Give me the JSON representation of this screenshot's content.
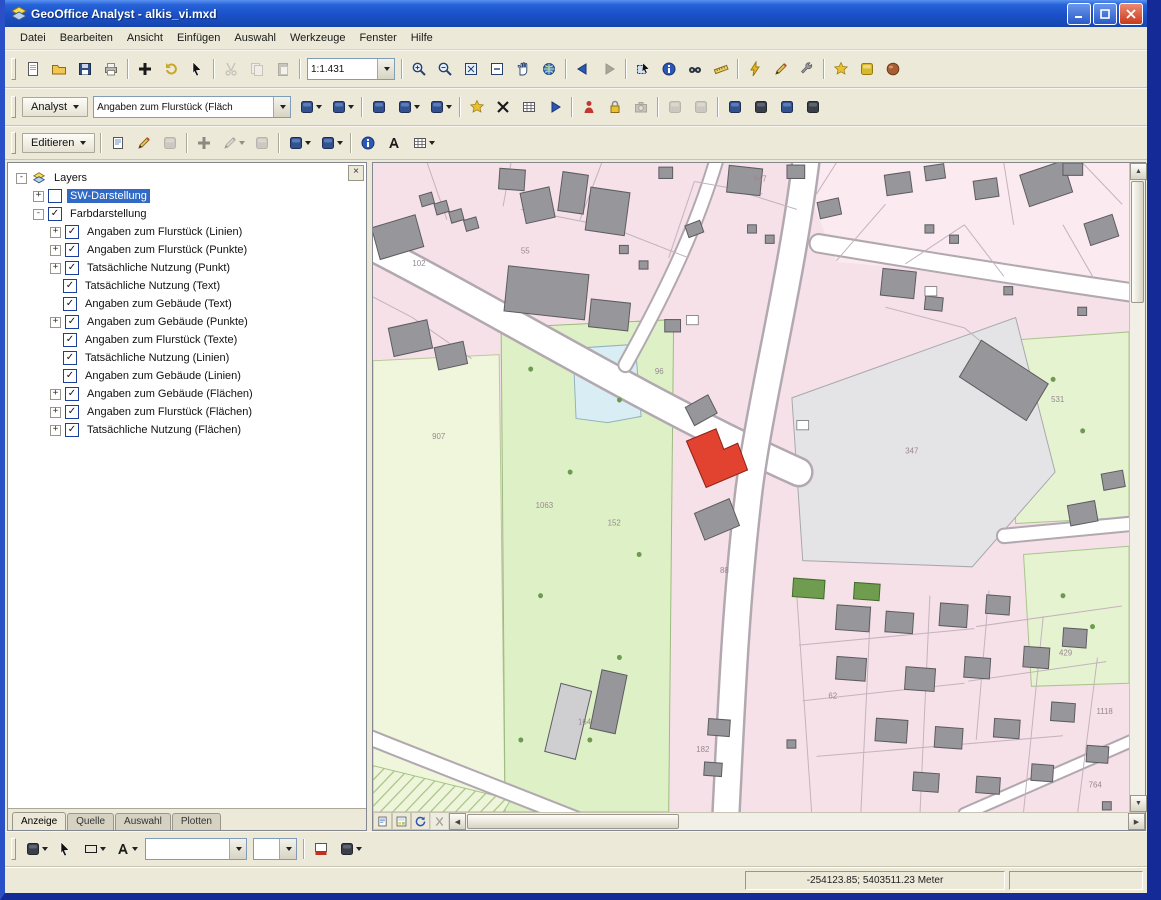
{
  "window": {
    "title": "GeoOffice Analyst - alkis_vi.mxd"
  },
  "menu": {
    "items": [
      "Datei",
      "Bearbeiten",
      "Ansicht",
      "Einfügen",
      "Auswahl",
      "Werkzeuge",
      "Fenster",
      "Hilfe"
    ]
  },
  "toolbar1": {
    "scale_value": "1:1.431"
  },
  "toolbar2": {
    "label": "Analyst",
    "combo_value": "Angaben zum Flurstück (Fläch"
  },
  "toolbar3": {
    "label": "Editieren"
  },
  "toolbar4": {
    "font_value": "",
    "size_value": ""
  },
  "toc": {
    "tabs": [
      "Anzeige",
      "Quelle",
      "Auswahl",
      "Plotten"
    ],
    "active_tab": "Anzeige",
    "layers": [
      {
        "label": "Layers",
        "level": 0,
        "expander": "-",
        "icon": "layers"
      },
      {
        "label": "SW-Darstellung",
        "level": 1,
        "expander": "+",
        "checked": false,
        "selected": true
      },
      {
        "label": "Farbdarstellung",
        "level": 1,
        "expander": "-",
        "checked": true
      },
      {
        "label": "Angaben zum Flurstück (Linien)",
        "level": 2,
        "expander": "+",
        "checked": true
      },
      {
        "label": "Angaben zum Flurstück (Punkte)",
        "level": 2,
        "expander": "+",
        "checked": true
      },
      {
        "label": "Tatsächliche Nutzung (Punkt)",
        "level": 2,
        "expander": "+",
        "checked": true
      },
      {
        "label": "Tatsächliche Nutzung (Text)",
        "level": 2,
        "checked": true
      },
      {
        "label": "Angaben zum Gebäude (Text)",
        "level": 2,
        "checked": true
      },
      {
        "label": "Angaben zum Gebäude (Punkte)",
        "level": 2,
        "expander": "+",
        "checked": true
      },
      {
        "label": "Angaben zum Flurstück (Texte)",
        "level": 2,
        "checked": true
      },
      {
        "label": "Tatsächliche Nutzung (Linien)",
        "level": 2,
        "checked": true
      },
      {
        "label": "Angaben zum Gebäude (Linien)",
        "level": 2,
        "checked": true
      },
      {
        "label": "Angaben zum Gebäude (Flächen)",
        "level": 2,
        "expander": "+",
        "checked": true
      },
      {
        "label": "Angaben zum Flurstück (Flächen)",
        "level": 2,
        "expander": "+",
        "checked": true
      },
      {
        "label": "Tatsächliche Nutzung (Flächen)",
        "level": 2,
        "expander": "+",
        "checked": true
      }
    ]
  },
  "map": {
    "selected_building_color": "#e24330",
    "labels": [
      {
        "text": "847",
        "x": 386,
        "y": 18
      },
      {
        "text": "102",
        "x": 40,
        "y": 100
      },
      {
        "text": "55",
        "x": 150,
        "y": 88
      },
      {
        "text": "907",
        "x": 60,
        "y": 268
      },
      {
        "text": "1063",
        "x": 165,
        "y": 335
      },
      {
        "text": "152",
        "x": 238,
        "y": 352
      },
      {
        "text": "96",
        "x": 286,
        "y": 205
      },
      {
        "text": "347",
        "x": 540,
        "y": 282
      },
      {
        "text": "531",
        "x": 688,
        "y": 232
      },
      {
        "text": "164",
        "x": 208,
        "y": 545
      },
      {
        "text": "88",
        "x": 352,
        "y": 398
      },
      {
        "text": "429",
        "x": 696,
        "y": 478
      },
      {
        "text": "1118",
        "x": 734,
        "y": 535
      },
      {
        "text": "764",
        "x": 726,
        "y": 606
      },
      {
        "text": "182",
        "x": 328,
        "y": 572
      },
      {
        "text": "62",
        "x": 462,
        "y": 520
      }
    ]
  },
  "statusbar": {
    "coordinates": "-254123.85; 5403511.23 Meter"
  }
}
